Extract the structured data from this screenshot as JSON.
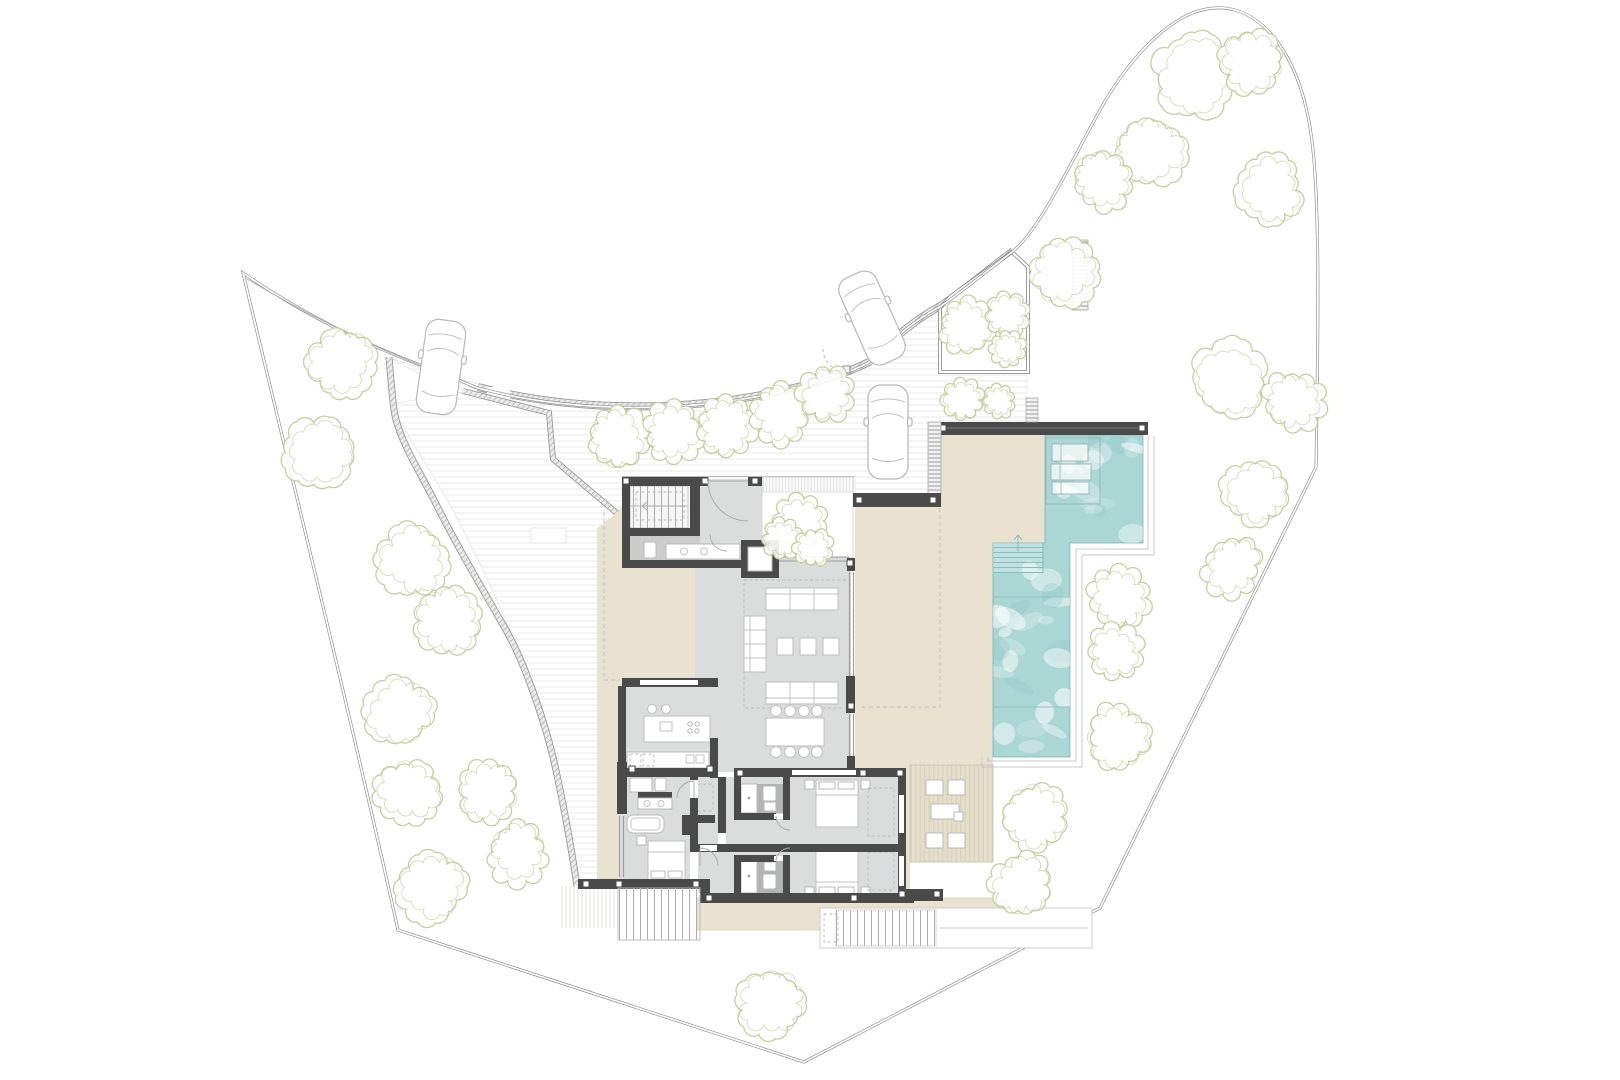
{
  "app": {
    "type": "architectural-site-plan",
    "floor": "ground-floor-villa-plan",
    "canvas_w": 1620,
    "canvas_h": 1080
  },
  "palette": {
    "background": "#ffffff",
    "wall_dark": "#4a4a4b",
    "interior_floor": "#dbdcdc",
    "wet_floor": "#b3b4b4",
    "terrace_beige": "#eae2d1",
    "deck_wood": "#e5decb",
    "deck_stripe": "#d6cfba",
    "pool_water": "#aad6d4",
    "pool_water_deep": "#8fc8c6",
    "pool_line": "#7fb0ae",
    "tree_stroke": "#c7cda0",
    "boundary_line": "#8a8a8a",
    "paving_stripe": "#ededec",
    "hatch_stroke": "#bdbdbd",
    "furniture_stroke": "#c3c3c3"
  },
  "site": {
    "boundary": "irregular-curved-parcel",
    "access": "curved-road-north",
    "rooms": [
      "stair-hall",
      "powder-room",
      "elevator",
      "entrance-hall",
      "courtyard",
      "living-room",
      "dining-area",
      "kitchen",
      "corridor",
      "master-bathroom",
      "master-bedroom",
      "bedroom-2",
      "bathroom-2",
      "bedroom-3",
      "bathroom-3",
      "terrace-west",
      "terrace-east",
      "south-terrace",
      "wood-deck",
      "pool",
      "parking-court",
      "driveway-ramp",
      "garden-enclosure"
    ]
  },
  "trees": [
    {
      "x": 1195,
      "y": 75,
      "r": 42
    },
    {
      "x": 1252,
      "y": 62,
      "r": 30
    },
    {
      "x": 1150,
      "y": 152,
      "r": 34
    },
    {
      "x": 1103,
      "y": 180,
      "r": 27
    },
    {
      "x": 1268,
      "y": 190,
      "r": 33
    },
    {
      "x": 1065,
      "y": 272,
      "r": 32
    },
    {
      "x": 1228,
      "y": 378,
      "r": 38
    },
    {
      "x": 1292,
      "y": 400,
      "r": 27
    },
    {
      "x": 1255,
      "y": 492,
      "r": 32
    },
    {
      "x": 1232,
      "y": 565,
      "r": 27
    },
    {
      "x": 1118,
      "y": 598,
      "r": 27
    },
    {
      "x": 1116,
      "y": 652,
      "r": 24
    },
    {
      "x": 1118,
      "y": 738,
      "r": 29
    },
    {
      "x": 1033,
      "y": 817,
      "r": 31
    },
    {
      "x": 1022,
      "y": 885,
      "r": 29
    },
    {
      "x": 968,
      "y": 328,
      "r": 25
    },
    {
      "x": 1007,
      "y": 316,
      "r": 19
    },
    {
      "x": 1007,
      "y": 349,
      "r": 15
    },
    {
      "x": 963,
      "y": 400,
      "r": 18
    },
    {
      "x": 999,
      "y": 401,
      "r": 14
    },
    {
      "x": 618,
      "y": 438,
      "r": 27
    },
    {
      "x": 674,
      "y": 432,
      "r": 26
    },
    {
      "x": 726,
      "y": 426,
      "r": 26
    },
    {
      "x": 781,
      "y": 414,
      "r": 26
    },
    {
      "x": 826,
      "y": 394,
      "r": 24
    },
    {
      "x": 342,
      "y": 362,
      "r": 33
    },
    {
      "x": 321,
      "y": 452,
      "r": 36
    },
    {
      "x": 412,
      "y": 560,
      "r": 34
    },
    {
      "x": 449,
      "y": 621,
      "r": 31
    },
    {
      "x": 397,
      "y": 713,
      "r": 33
    },
    {
      "x": 409,
      "y": 791,
      "r": 30
    },
    {
      "x": 487,
      "y": 791,
      "r": 28
    },
    {
      "x": 431,
      "y": 887,
      "r": 34
    },
    {
      "x": 517,
      "y": 852,
      "r": 27
    },
    {
      "x": 800,
      "y": 521,
      "r": 21
    },
    {
      "x": 782,
      "y": 539,
      "r": 17
    },
    {
      "x": 813,
      "y": 548,
      "r": 17
    },
    {
      "x": 771,
      "y": 1003,
      "r": 33
    }
  ],
  "cars": [
    {
      "x": 441,
      "y": 367,
      "rot": 8
    },
    {
      "x": 872,
      "y": 318,
      "rot": -24
    },
    {
      "x": 888,
      "y": 432,
      "rot": 0
    }
  ],
  "pool": {
    "lane_lines_y": [
      597,
      707
    ],
    "loungers": [
      [
        1052,
        444,
        36,
        17
      ],
      [
        1051,
        464,
        40,
        16
      ],
      [
        1052,
        482,
        37,
        12
      ]
    ],
    "steps": {
      "x": 993,
      "y": 543,
      "w": 50,
      "h": 30
    },
    "water_seed": 7,
    "blob_count": 38
  },
  "deck": {
    "chairs": [
      [
        926,
        780
      ],
      [
        948,
        780
      ],
      [
        926,
        833
      ],
      [
        948,
        833
      ]
    ],
    "table": [
      931,
      804,
      28,
      15
    ],
    "side_table": [
      954,
      812,
      9,
      9
    ]
  }
}
